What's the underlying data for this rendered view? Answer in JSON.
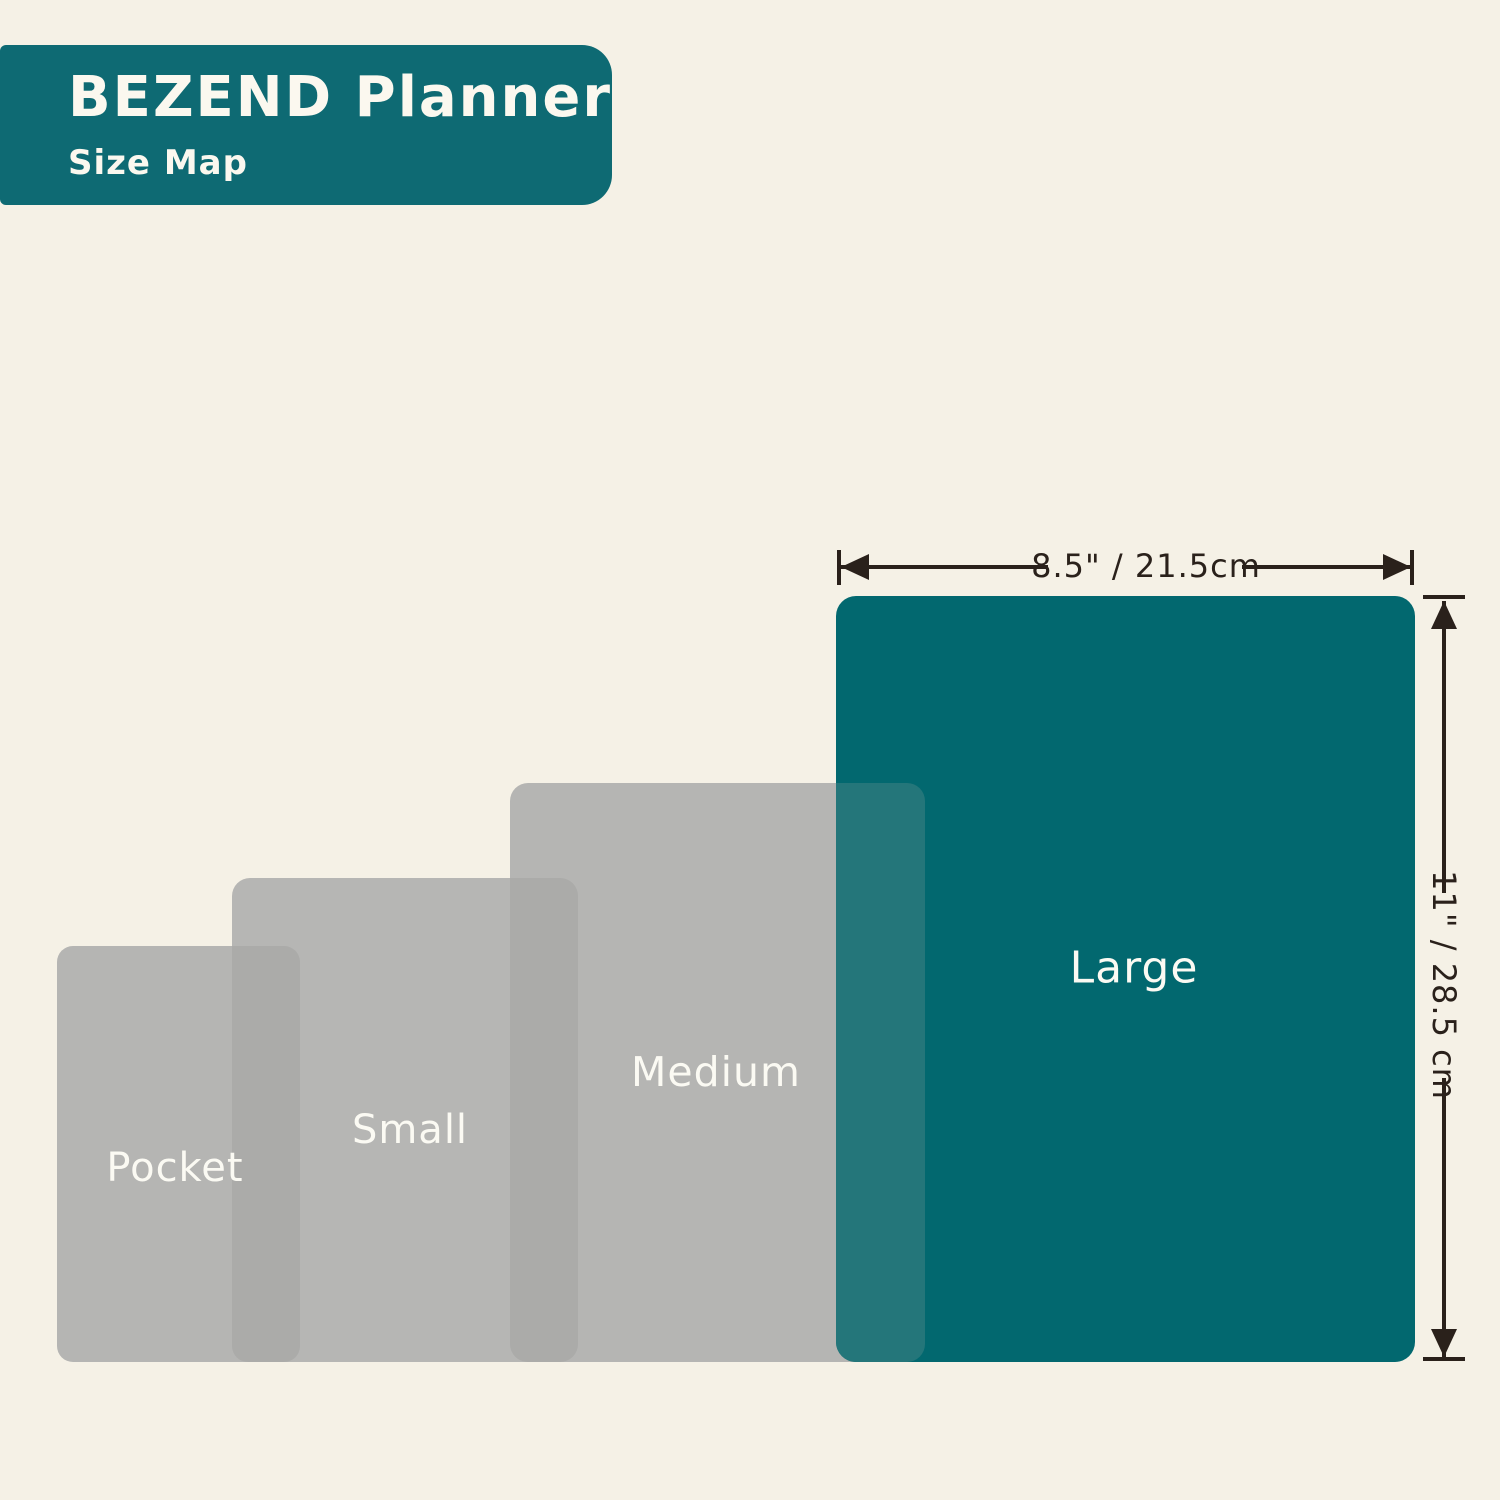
{
  "header": {
    "title": "BEZEND Planner",
    "subtitle": "Size Map"
  },
  "diagram": {
    "sizes": [
      {
        "id": "pocket",
        "label": "Pocket"
      },
      {
        "id": "small",
        "label": "Small"
      },
      {
        "id": "medium",
        "label": "Medium"
      },
      {
        "id": "large",
        "label": "Large"
      }
    ],
    "large_width_dimension": "8.5\" / 21.5cm",
    "large_height_dimension": "11\" / 28.5 cm"
  },
  "colors": {
    "background": "#f5f1e6",
    "header_teal": "#0e6a73",
    "large_teal": "#02686f",
    "gray_rect": "#b5b5b3",
    "gray_overlap": "#ababa9",
    "gray_over_teal_overlap": "#24767a",
    "dimension_ink": "#2a211b",
    "label_text": "#fbfaf3"
  }
}
